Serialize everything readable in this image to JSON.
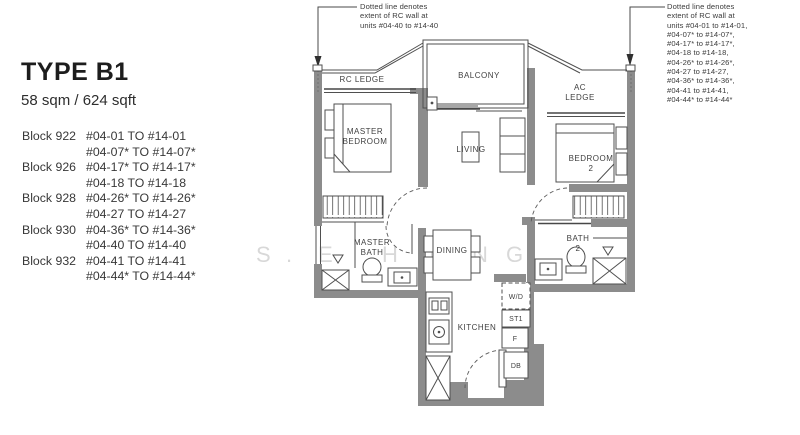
{
  "header": {
    "title": "TYPE B1",
    "area": "58 sqm / 624 sqft"
  },
  "unit_schedule": [
    {
      "block": "Block 922",
      "line1": "#04-01 TO #14-01",
      "line2": "#04-07* TO #14-07*"
    },
    {
      "block": "Block 926",
      "line1": "#04-17* TO #14-17*",
      "line2": "#04-18 TO #14-18"
    },
    {
      "block": "Block 928",
      "line1": "#04-26* TO #14-26*",
      "line2": "#04-27 TO #14-27"
    },
    {
      "block": "Block 930",
      "line1": "#04-36* TO #14-36*",
      "line2": "#04-40 TO #14-40"
    },
    {
      "block": "Block 932",
      "line1": "#04-41 TO #14-41",
      "line2": "#04-44* TO #14-44*"
    }
  ],
  "annotation_left": {
    "lines": [
      "Dotted line denotes",
      "extent of RC wall at",
      "units #04-40 to #14-40"
    ]
  },
  "annotation_right": {
    "lines": [
      "Dotted line denotes",
      "extent of RC wall at",
      "units #04-01 to #14-01,",
      "#04-07* to #14-07*,",
      "#04-17* to #14-17*,",
      "#04-18 to #14-18,",
      "#04-26* to #14-26*,",
      "#04-27 to #14-27,",
      "#04-36* to #14-36*,",
      "#04-41 to #14-41,",
      "#04-44* to #14-44*"
    ]
  },
  "plan_labels": {
    "rc_ledge": "RC LEDGE",
    "balcony": "BALCONY",
    "ac_ledge_line1": "AC",
    "ac_ledge_line2": "LEDGE",
    "master_bedroom_line1": "MASTER",
    "master_bedroom_line2": "BEDROOM",
    "living": "LIVING",
    "bedroom2_line1": "BEDROOM",
    "bedroom2_line2": "2",
    "master_bath_line1": "MASTER",
    "master_bath_line2": "BATH",
    "dining": "DINING",
    "bath2_line1": "BATH",
    "bath2_line2": "2",
    "kitchen": "KITCHEN",
    "washer_dryer": "W/D",
    "store": "ST1",
    "fridge": "F",
    "db": "DB"
  },
  "watermark": {
    "letters": [
      "S",
      ".",
      "E",
      "H",
      "O",
      "N",
      "G"
    ]
  },
  "colors": {
    "wall": "#8c8c8c",
    "thin_line": "#4f4f4f",
    "label_text": "#3f3f3f",
    "panel_text": "#2e2e2e",
    "watermark": "#c9c9c9"
  }
}
